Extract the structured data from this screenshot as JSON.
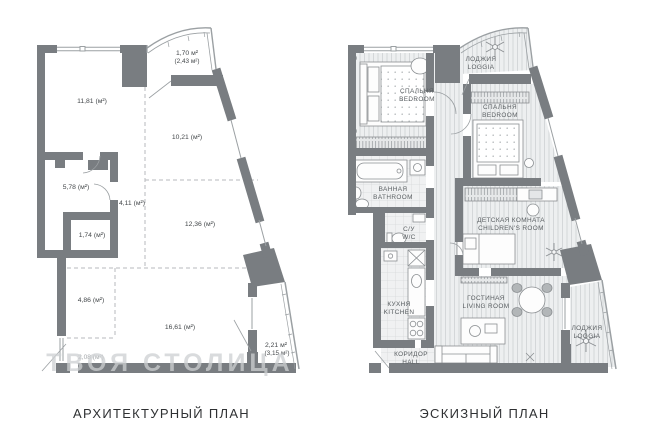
{
  "page": {
    "background": "#ffffff"
  },
  "colors": {
    "wall": "#797d81",
    "thin_line": "#9ba0a3",
    "dashed_line": "#b7babc",
    "floor_wood": "#edeff0",
    "floor_tile": "#f1f2f3",
    "furniture_stroke": "#8b8f92",
    "label_text": "#44484b",
    "room_text": "#595e61",
    "caption_text": "#2f3133",
    "watermark_text": "#cdd0d2"
  },
  "left_plan": {
    "caption": "АРХИТЕКТУРНЫЙ ПЛАН",
    "watermark": "ТВОЯ СТОЛИЦА",
    "areas": [
      {
        "id": "room-11-81",
        "label": "11,81 (м²)"
      },
      {
        "id": "loggia-top",
        "label": "1,70 м²",
        "label2": "(2,43 м²)"
      },
      {
        "id": "room-10-21",
        "label": "10,21 (м²)"
      },
      {
        "id": "room-5-78",
        "label": "5,78 (м²)"
      },
      {
        "id": "corridor-4-11",
        "label": "4,11 (м²)"
      },
      {
        "id": "room-1-74",
        "label": "1,74 (м²)"
      },
      {
        "id": "room-12-36",
        "label": "12,36 (м²)"
      },
      {
        "id": "room-4-86",
        "label": "4,86 (м²)"
      },
      {
        "id": "room-16-61",
        "label": "16,61 (м²)"
      },
      {
        "id": "room-2-08",
        "label": "2,08 (м²)"
      },
      {
        "id": "loggia-bottom",
        "label": "2,21 м²",
        "label2": "(3,15 м²)"
      }
    ]
  },
  "right_plan": {
    "caption": "ЭСКИЗНЫЙ ПЛАН",
    "rooms": [
      {
        "id": "loggia-top",
        "ru": "ЛОДЖИЯ",
        "en": "LOGGIA"
      },
      {
        "id": "bedroom-1",
        "ru": "СПАЛЬНЯ",
        "en": "BEDROOM"
      },
      {
        "id": "bedroom-2",
        "ru": "СПАЛЬНЯ",
        "en": "BEDROOM"
      },
      {
        "id": "bathroom",
        "ru": "ВАННАЯ",
        "en": "BATHROOM"
      },
      {
        "id": "wc",
        "ru": "С/У",
        "en": "W/C"
      },
      {
        "id": "children-room",
        "ru": "ДЕТСКАЯ КОМНАТА",
        "en": "CHILDREN'S ROOM"
      },
      {
        "id": "kitchen",
        "ru": "КУХНЯ",
        "en": "KITCHEN"
      },
      {
        "id": "living-room",
        "ru": "ГОСТИНАЯ",
        "en": "LIVING ROOM"
      },
      {
        "id": "hall",
        "ru": "КОРИДОР",
        "en": "HALL"
      },
      {
        "id": "loggia-bottom",
        "ru": "ЛОДЖИЯ",
        "en": "LOGGIA"
      }
    ]
  }
}
